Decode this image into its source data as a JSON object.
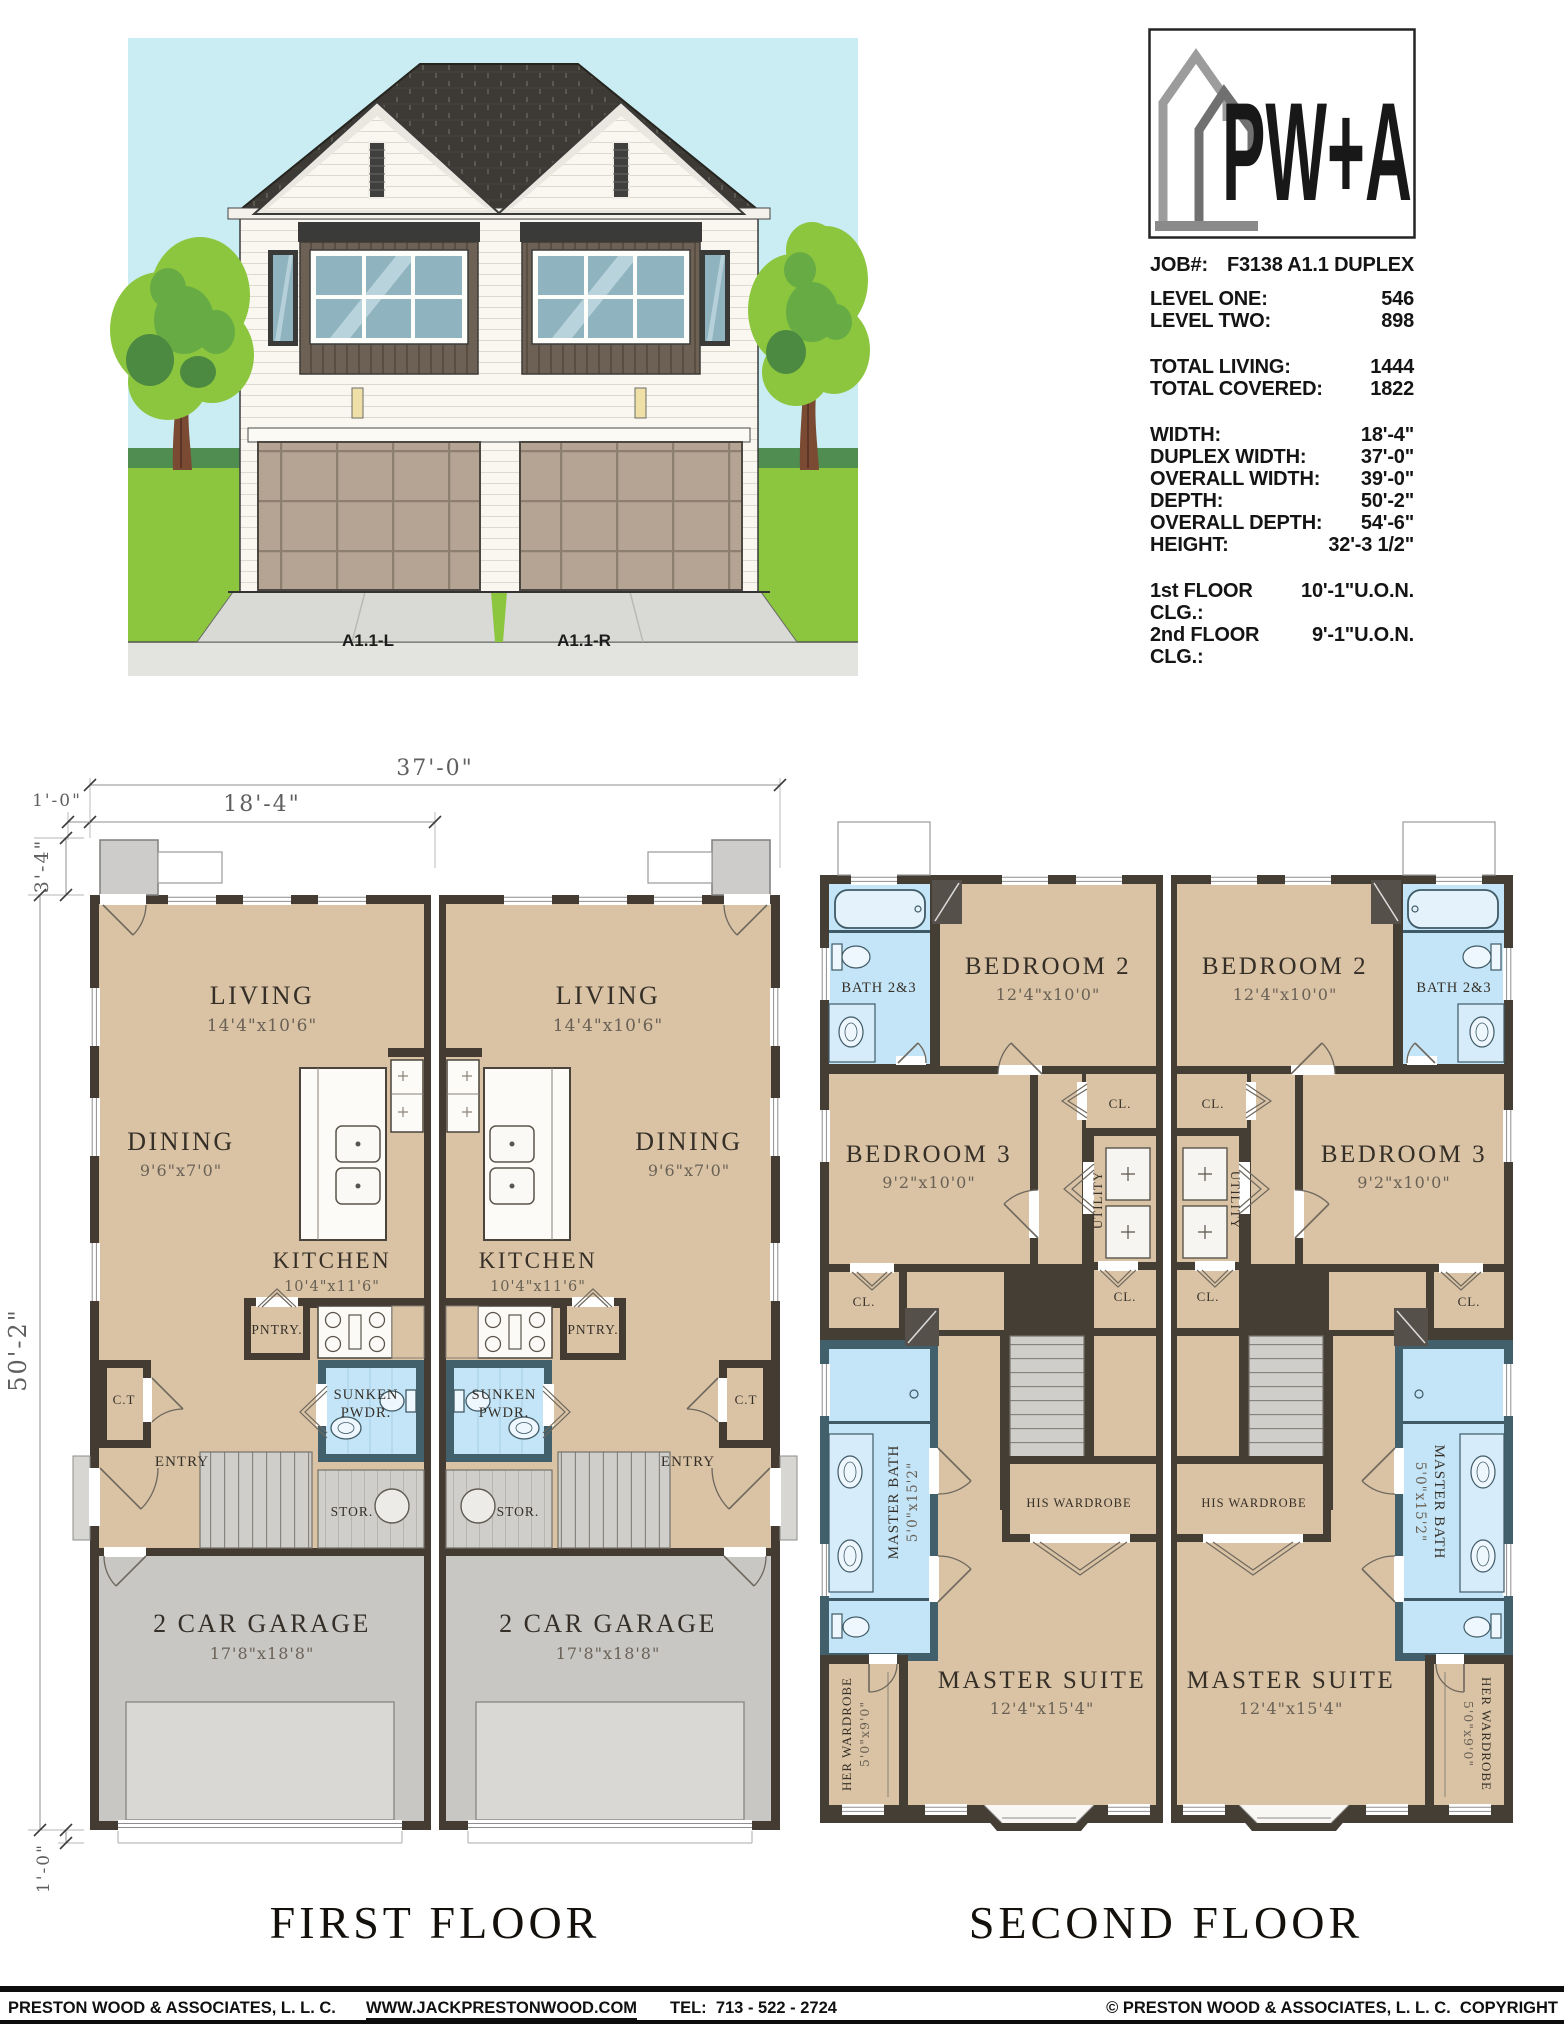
{
  "elevation": {
    "left_unit_label": "A1.1-L",
    "right_unit_label": "A1.1-R"
  },
  "logo": {
    "brand": "PW+A"
  },
  "info": {
    "job_label": "JOB#:",
    "job_value": "F3138 A1.1 DUPLEX",
    "rows": [
      {
        "label": "LEVEL ONE:",
        "value": "546"
      },
      {
        "label": "LEVEL TWO:",
        "value": "898"
      },
      {
        "label": "TOTAL LIVING:",
        "value": "1444"
      },
      {
        "label": "TOTAL COVERED:",
        "value": "1822"
      },
      {
        "label": "WIDTH:",
        "value": "18'-4\""
      },
      {
        "label": "DUPLEX WIDTH:",
        "value": "37'-0\""
      },
      {
        "label": "OVERALL WIDTH:",
        "value": "39'-0\""
      },
      {
        "label": "DEPTH:",
        "value": "50'-2\""
      },
      {
        "label": "OVERALL DEPTH:",
        "value": "54'-6\""
      },
      {
        "label": "HEIGHT:",
        "value": "32'-3 1/2\""
      },
      {
        "label": "1st FLOOR CLG.:",
        "value": "10'-1\"U.O.N."
      },
      {
        "label": "2nd FLOOR CLG.:",
        "value": "9'-1\"U.O.N."
      }
    ]
  },
  "floor1": {
    "title": "FIRST FLOOR",
    "dims": {
      "overall_width": "37'-0\"",
      "unit_width": "18'-4\"",
      "porch_offset": "1'-0\"",
      "porch_depth": "3'-4\"",
      "depth": "50'-2\"",
      "slab_offset": "1'-0\""
    },
    "rooms": {
      "living": {
        "name": "LIVING",
        "size": "14'4\"x10'6\""
      },
      "dining": {
        "name": "DINING",
        "size": "9'6\"x7'0\""
      },
      "kitchen": {
        "name": "KITCHEN",
        "size": "10'4\"x11'6\""
      },
      "pantry": "PNTRY.",
      "powder_line1": "SUNKEN",
      "powder_line2": "PWDR.",
      "coat": "C.T",
      "entry": "ENTRY",
      "storage": "STOR.",
      "garage": {
        "name": "2 CAR GARAGE",
        "size": "17'8\"x18'8\""
      }
    }
  },
  "floor2": {
    "title": "SECOND FLOOR",
    "rooms": {
      "bath23": "BATH 2&3",
      "bedroom2": {
        "name": "BEDROOM 2",
        "size": "12'4\"x10'0\""
      },
      "bedroom3": {
        "name": "BEDROOM 3",
        "size": "9'2\"x10'0\""
      },
      "closet": "CL.",
      "utility": "UTILITY",
      "master_bath": {
        "name": "MASTER BATH",
        "size": "5'0\"x15'2\""
      },
      "his_wardrobe": "HIS WARDROBE",
      "master_suite": {
        "name": "MASTER SUITE",
        "size": "12'4\"x15'4\""
      },
      "her_wardrobe": {
        "name": "HER WARDROBE",
        "size": "5'0\"x9'0\""
      }
    }
  },
  "footer": {
    "company": "PRESTON WOOD & ASSOCIATES, L. L. C.",
    "website": "WWW.JACKPRESTONWOOD.COM",
    "tel": "TEL:  713 - 522 - 2724",
    "copyright": "© PRESTON WOOD & ASSOCIATES, L. L. C.  COPYRIGHT"
  }
}
